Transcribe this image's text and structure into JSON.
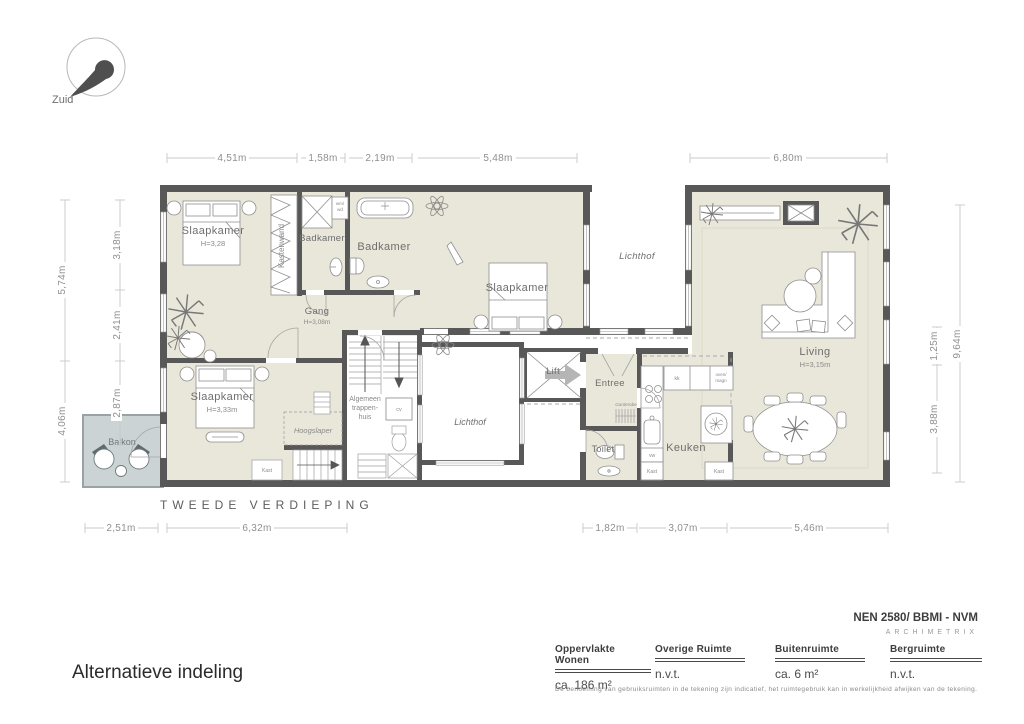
{
  "compass": {
    "label": "Zuid"
  },
  "plan": {
    "floor_label": "TWEEDE VERDIEPING",
    "rooms": {
      "slaapkamer_1": {
        "name": "Slaapkamer",
        "height": "H=3,28"
      },
      "slaapkamer_2": {
        "name": "Slaapkamer"
      },
      "slaapkamer_3": {
        "name": "Slaapkamer",
        "height": "H=3,33m"
      },
      "badkamer_klein": "Badkamer",
      "badkamer_groot": "Badkamer",
      "kastenwand": "Kastenwand",
      "gang": {
        "name": "Gang",
        "height": "H=3,08m"
      },
      "lichthof_boven": "Lichthof",
      "lichthof_onder": "Lichthof",
      "living": {
        "name": "Living",
        "height": "H=3,15m"
      },
      "entree": "Entree",
      "toilet": "Toilet",
      "keuken": "Keuken",
      "lift": "Lift",
      "balkon": "Balkon",
      "hoogslaper": "Hoogslaper",
      "trappenhuis": [
        "Algemeen",
        "trappen-",
        "huis"
      ],
      "garderobe": "Garderobe"
    },
    "small_labels": {
      "kast": "Kast",
      "cv": "cv",
      "vw": "vw",
      "kk": "kk",
      "wm_wd": [
        "wm/",
        "wd"
      ],
      "oven_magn": [
        "oven/",
        "magn"
      ]
    },
    "dims": {
      "top": [
        "4,51m",
        "1,58m",
        "2,19m",
        "5,48m",
        "6,80m"
      ],
      "left_outer": [
        "5,74m",
        "4,06m"
      ],
      "left_inner": [
        "3,18m",
        "2,41m",
        "2,87m"
      ],
      "right_inner": [
        "1,25m",
        "3,88m"
      ],
      "right_outer": [
        "9,64m"
      ],
      "bottom": [
        "2,51m",
        "6,32m",
        "1,82m",
        "3,07m",
        "5,46m"
      ]
    }
  },
  "footer": {
    "title": "Alternatieve indeling",
    "standard": "NEN 2580/ BBMI - NVM",
    "brand": "ARCHIMETRIX",
    "columns": [
      {
        "label": "Oppervlakte Wonen",
        "value": "ca. 186 m²"
      },
      {
        "label": "Overige  Ruimte",
        "value": "n.v.t."
      },
      {
        "label": "Buitenruimte",
        "value": "ca. 6 m²"
      },
      {
        "label": "Bergruimte",
        "value": "n.v.t."
      }
    ],
    "disclaimer": "De benoeming van gebruiksruimten in de tekening zijn indicatief, het ruimtegebruik kan in werkelijkheid afwijken van de tekening."
  },
  "colors": {
    "wall": "#585858",
    "floor": "#e9e7da",
    "balcony": "#ccd3d4"
  }
}
